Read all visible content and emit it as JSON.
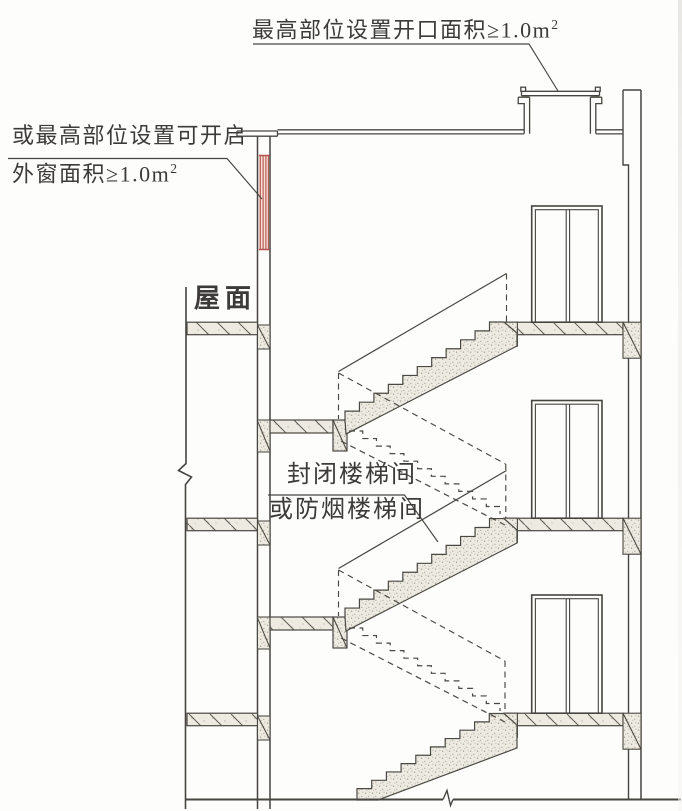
{
  "figure": {
    "kind": "stairwell-section-diagram",
    "annotations": {
      "roof_opening": {
        "text": "最高部位设置开口面积≥1.0m",
        "sup": "2"
      },
      "openable_window": {
        "line1": "或最高部位设置可开启",
        "line2": "外窗面积≥1.0m",
        "sup": "2"
      },
      "roof_surface": {
        "text": "屋面"
      },
      "stairwell": {
        "line1": "封闭楼梯间",
        "line2": "或防烟楼梯间"
      }
    },
    "colors": {
      "line": "#474540",
      "text": "#3c3b38",
      "window_red": "#b4554b",
      "window_fill": "#f6ddd7",
      "concrete_fill": "#edeae2",
      "paper": "#fdfdfb"
    }
  }
}
